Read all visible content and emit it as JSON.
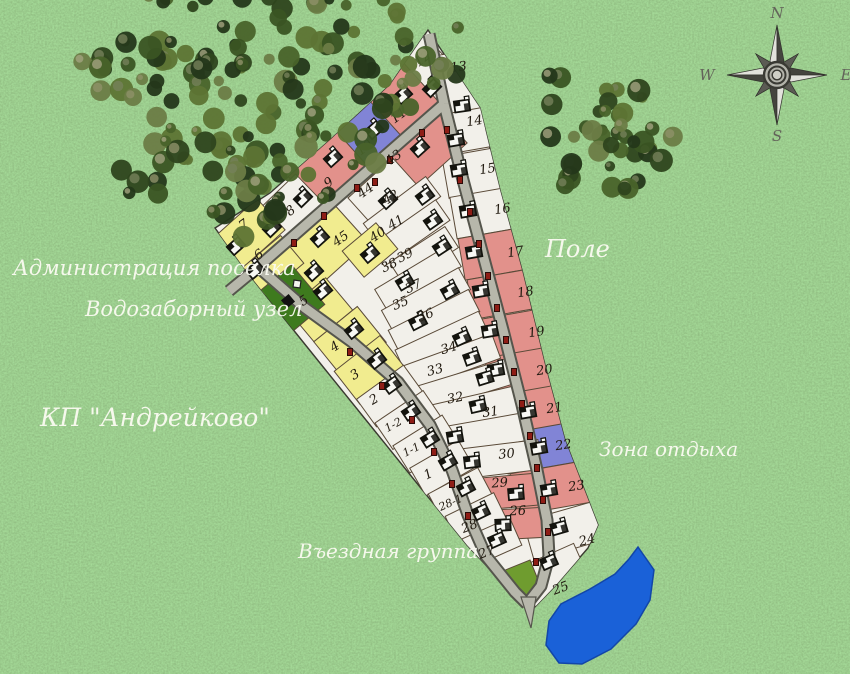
{
  "settlement_name": "КП \"Андрейково\"",
  "labels": {
    "administration": "Администрация поселка",
    "water_intake": "Водозаборный узел",
    "field": "Поле",
    "recreation_area": "Зона отдыха",
    "entrance_group": "Въездная группа"
  },
  "compass": {
    "north": "N",
    "west": "W",
    "east": "E",
    "south": "S"
  },
  "colors": {
    "plot_regular": "#f2f0ea",
    "plot_red": "#e2918b",
    "plot_blue": "#8184d6",
    "plot_yellow": "#f1ec8f",
    "plot_admin_green": "#3e7a1e",
    "plot_entrance_green": "#6f9c2f",
    "road_fill": "#b7b7ab",
    "road_edge": "#55554c",
    "water": "#1a61d8",
    "boundary": "#3a3a30"
  },
  "plots": [
    {
      "n": "12",
      "c": "p",
      "cx": 428,
      "cy": 68,
      "w": 40,
      "h": 58,
      "rot": -45,
      "lx": 425,
      "ly": 62,
      "hs": [
        [
          432,
          88
        ]
      ]
    },
    {
      "n": "13",
      "c": "p",
      "cx": 464,
      "cy": 92,
      "w": 50,
      "h": 80,
      "rot": -8,
      "lx": 459,
      "ly": 71,
      "hs": [
        [
          462,
          106
        ]
      ]
    },
    {
      "n": "14",
      "c": "p",
      "cx": 470,
      "cy": 130,
      "w": 58,
      "h": 40,
      "rot": -10,
      "lx": 475,
      "ly": 125,
      "hs": [
        [
          456,
          140
        ]
      ]
    },
    {
      "n": "15",
      "c": "p",
      "cx": 478,
      "cy": 172,
      "w": 66,
      "h": 42,
      "rot": -10,
      "lx": 488,
      "ly": 173,
      "hs": [
        [
          459,
          170
        ]
      ]
    },
    {
      "n": "16",
      "c": "p",
      "cx": 488,
      "cy": 212,
      "w": 70,
      "h": 42,
      "rot": -10,
      "lx": 503,
      "ly": 213,
      "hs": [
        [
          468,
          211
        ]
      ]
    },
    {
      "n": "17",
      "c": "r",
      "cx": 498,
      "cy": 253,
      "w": 74,
      "h": 42,
      "rot": -10,
      "lx": 516,
      "ly": 256,
      "hs": [
        [
          474,
          252
        ]
      ]
    },
    {
      "n": "18",
      "c": "r",
      "cx": 508,
      "cy": 293,
      "w": 76,
      "h": 40,
      "rot": -10,
      "lx": 526,
      "ly": 296,
      "hs": [
        [
          481,
          291
        ]
      ]
    },
    {
      "n": "19",
      "c": "r",
      "cx": 518,
      "cy": 333,
      "w": 78,
      "h": 40,
      "rot": -10,
      "lx": 537,
      "ly": 336,
      "hs": [
        [
          490,
          331
        ]
      ]
    },
    {
      "n": "20",
      "c": "r",
      "cx": 527,
      "cy": 371,
      "w": 80,
      "h": 40,
      "rot": -10,
      "lx": 545,
      "ly": 374,
      "hs": [
        [
          496,
          370
        ]
      ]
    },
    {
      "n": "21",
      "c": "r",
      "cx": 536,
      "cy": 409,
      "w": 82,
      "h": 40,
      "rot": -10,
      "lx": 555,
      "ly": 412,
      "hs": [
        [
          528,
          412
        ]
      ]
    },
    {
      "n": "22",
      "c": "b",
      "cx": 546,
      "cy": 447,
      "w": 84,
      "h": 40,
      "rot": -10,
      "lx": 564,
      "ly": 449,
      "hs": [
        [
          539,
          448
        ]
      ]
    },
    {
      "n": "23",
      "c": "r",
      "cx": 556,
      "cy": 487,
      "w": 86,
      "h": 42,
      "rot": -10,
      "lx": 577,
      "ly": 490,
      "hs": [
        [
          549,
          490
        ]
      ]
    },
    {
      "n": "24",
      "c": "p",
      "cx": 566,
      "cy": 530,
      "w": 78,
      "h": 40,
      "rot": -16,
      "lx": 588,
      "ly": 544,
      "hs": [
        [
          559,
          528
        ]
      ]
    },
    {
      "n": "25",
      "c": "p",
      "cx": 552,
      "cy": 576,
      "w": 66,
      "h": 42,
      "rot": -24,
      "lx": 562,
      "ly": 592,
      "hs": [
        [
          549,
          562
        ]
      ]
    },
    {
      "n": "11",
      "c": "r",
      "cx": 398,
      "cy": 100,
      "w": 58,
      "h": 60,
      "rot": -42,
      "lx": 401,
      "ly": 119,
      "hs": [
        [
          403,
          95
        ]
      ]
    },
    {
      "n": "10",
      "c": "b",
      "cx": 365,
      "cy": 133,
      "w": 50,
      "h": 55,
      "rot": -42,
      "lx": 367,
      "ly": 151,
      "hs": [
        [
          374,
          130
        ]
      ]
    },
    {
      "n": "9",
      "c": "r",
      "cx": 325,
      "cy": 168,
      "w": 66,
      "h": 52,
      "rot": -42,
      "lx": 331,
      "ly": 186,
      "hs": [
        [
          333,
          158
        ]
      ]
    },
    {
      "n": "43",
      "c": "r",
      "cx": 425,
      "cy": 150,
      "w": 72,
      "h": 46,
      "rot": -42,
      "lx": 396,
      "ly": 161,
      "hs": [
        [
          420,
          148
        ]
      ]
    },
    {
      "n": "44",
      "c": "p",
      "cx": 383,
      "cy": 192,
      "w": 60,
      "h": 38,
      "rot": -42,
      "lx": 368,
      "ly": 194,
      "hs": [
        [
          388,
          200
        ]
      ]
    },
    {
      "n": "45",
      "c": "y",
      "cx": 318,
      "cy": 250,
      "w": 85,
      "h": 55,
      "rot": -42,
      "lx": 343,
      "ly": 242,
      "hs": [
        [
          320,
          238
        ],
        [
          314,
          272
        ]
      ]
    },
    {
      "n": "42",
      "c": "p",
      "cx": 402,
      "cy": 210,
      "w": 78,
      "h": 25,
      "rot": -37,
      "lx": 393,
      "ly": 201,
      "hs": [
        [
          425,
          196
        ]
      ]
    },
    {
      "n": "41",
      "c": "p",
      "cx": 410,
      "cy": 233,
      "w": 80,
      "h": 25,
      "rot": -35,
      "lx": 398,
      "ly": 226,
      "hs": [
        [
          433,
          221
        ]
      ]
    },
    {
      "n": "40",
      "c": "y",
      "cx": 370,
      "cy": 250,
      "w": 44,
      "h": 34,
      "rot": -40,
      "lx": 380,
      "ly": 238,
      "hs": [
        [
          370,
          254
        ]
      ]
    },
    {
      "n": "39",
      "c": "p",
      "cx": 424,
      "cy": 255,
      "w": 66,
      "h": 25,
      "rot": -33,
      "lx": 407,
      "ly": 259,
      "hs": [
        [
          442,
          247
        ]
      ]
    },
    {
      "n": "38",
      "c": "p",
      "cx": 418,
      "cy": 278,
      "w": 86,
      "h": 25,
      "rot": -31,
      "lx": 391,
      "ly": 269,
      "hs": [
        [
          405,
          282
        ]
      ]
    },
    {
      "n": "37",
      "c": "p",
      "cx": 426,
      "cy": 300,
      "w": 88,
      "h": 25,
      "rot": -29,
      "lx": 415,
      "ly": 290,
      "hs": [
        [
          450,
          291
        ]
      ]
    },
    {
      "n": "35",
      "c": "p",
      "cx": 434,
      "cy": 321,
      "w": 90,
      "h": 25,
      "rot": -27,
      "lx": 402,
      "ly": 307,
      "hs": [
        [
          418,
          322
        ]
      ]
    },
    {
      "n": "36",
      "c": "p",
      "cx": 442,
      "cy": 342,
      "w": 92,
      "h": 25,
      "rot": -25,
      "lx": 427,
      "ly": 319,
      "hs": [
        [
          462,
          338
        ]
      ]
    },
    {
      "n": "34",
      "c": "p",
      "cx": 452,
      "cy": 362,
      "w": 94,
      "h": 26,
      "rot": -20,
      "lx": 450,
      "ly": 352,
      "hs": [
        [
          472,
          358
        ]
      ]
    },
    {
      "n": "33",
      "c": "p",
      "cx": 462,
      "cy": 386,
      "w": 96,
      "h": 26,
      "rot": -17,
      "lx": 436,
      "ly": 374,
      "hs": [
        [
          485,
          378
        ]
      ]
    },
    {
      "n": "32",
      "c": "p",
      "cx": 472,
      "cy": 410,
      "w": 96,
      "h": 28,
      "rot": -13,
      "lx": 456,
      "ly": 402,
      "hs": [
        [
          478,
          406
        ]
      ]
    },
    {
      "n": "31",
      "c": "p",
      "cx": 483,
      "cy": 434,
      "w": 94,
      "h": 28,
      "rot": -10,
      "lx": 491,
      "ly": 416,
      "hs": [
        [
          455,
          437
        ]
      ]
    },
    {
      "n": "30",
      "c": "p",
      "cx": 494,
      "cy": 460,
      "w": 92,
      "h": 30,
      "rot": -7,
      "lx": 507,
      "ly": 458,
      "hs": [
        [
          472,
          462
        ]
      ]
    },
    {
      "n": "29",
      "c": "r",
      "cx": 504,
      "cy": 492,
      "w": 74,
      "h": 32,
      "rot": -5,
      "lx": 500,
      "ly": 487,
      "hs": [
        [
          516,
          494
        ]
      ]
    },
    {
      "n": "26",
      "c": "r",
      "cx": 512,
      "cy": 524,
      "w": 62,
      "h": 30,
      "rot": -3,
      "lx": 518,
      "ly": 515,
      "hs": [
        [
          503,
          525
        ]
      ]
    },
    {
      "n": "8",
      "c": "p",
      "cx": 290,
      "cy": 210,
      "w": 58,
      "h": 44,
      "rot": -44,
      "lx": 293,
      "ly": 214,
      "hs": [
        [
          303,
          198
        ],
        [
          272,
          228
        ]
      ]
    },
    {
      "n": "7",
      "c": "y",
      "cx": 248,
      "cy": 235,
      "w": 62,
      "h": 42,
      "rot": -42,
      "lx": 246,
      "ly": 228,
      "hs": [
        [
          236,
          246
        ]
      ]
    },
    {
      "n": "6",
      "c": "y",
      "cx": 270,
      "cy": 268,
      "w": 58,
      "h": 36,
      "rot": -40,
      "lx": 261,
      "ly": 258,
      "hs": [
        [
          255,
          270
        ]
      ]
    },
    {
      "n": "5",
      "c": "y",
      "cx": 320,
      "cy": 310,
      "w": 50,
      "h": 42,
      "rot": -40,
      "lx": 306,
      "ly": 304,
      "hs": [
        [
          323,
          291
        ]
      ]
    },
    {
      "n": "4",
      "c": "y",
      "cx": 350,
      "cy": 342,
      "w": 56,
      "h": 46,
      "rot": -39,
      "lx": 337,
      "ly": 350,
      "hs": [
        [
          354,
          330
        ]
      ]
    },
    {
      "n": "3",
      "c": "y",
      "cx": 370,
      "cy": 370,
      "w": 58,
      "h": 42,
      "rot": -38,
      "lx": 357,
      "ly": 378,
      "hs": [
        [
          377,
          360
        ]
      ]
    },
    {
      "n": "2",
      "c": "p",
      "cx": 390,
      "cy": 396,
      "w": 58,
      "h": 34,
      "rot": -36,
      "lx": 376,
      "ly": 403,
      "hs": [
        [
          392,
          385
        ]
      ]
    },
    {
      "n": "1-2",
      "c": "p",
      "cx": 408,
      "cy": 420,
      "w": 58,
      "h": 32,
      "rot": -34,
      "lx": 395,
      "ly": 428,
      "hs": [
        [
          411,
          412
        ]
      ]
    },
    {
      "n": "1-1",
      "c": "p",
      "cx": 426,
      "cy": 444,
      "w": 58,
      "h": 32,
      "rot": -32,
      "lx": 413,
      "ly": 453,
      "hs": [
        [
          430,
          439
        ]
      ]
    },
    {
      "n": "1",
      "c": "p",
      "cx": 442,
      "cy": 468,
      "w": 56,
      "h": 32,
      "rot": -30,
      "lx": 430,
      "ly": 478,
      "hs": [
        [
          448,
          462
        ]
      ]
    },
    {
      "n": "28-1",
      "c": "p",
      "cx": 460,
      "cy": 494,
      "w": 56,
      "h": 30,
      "rot": -28,
      "lx": 452,
      "ly": 506,
      "hs": [
        [
          466,
          488
        ]
      ]
    },
    {
      "n": "28",
      "c": "p",
      "cx": 476,
      "cy": 518,
      "w": 54,
      "h": 30,
      "rot": -26,
      "lx": 471,
      "ly": 530,
      "hs": [
        [
          481,
          512
        ]
      ]
    },
    {
      "n": "27",
      "c": "p",
      "cx": 492,
      "cy": 542,
      "w": 52,
      "h": 30,
      "rot": -24,
      "lx": 488,
      "ly": 556,
      "hs": [
        [
          497,
          540
        ]
      ]
    },
    {
      "n": "",
      "c": "g1",
      "cx": 292,
      "cy": 298,
      "w": 42,
      "h": 52,
      "rot": -40,
      "lx": 0,
      "ly": 0,
      "hs": []
    },
    {
      "n": "",
      "c": "g2",
      "cx": 516,
      "cy": 584,
      "w": 44,
      "h": 34,
      "rot": -22,
      "lx": 0,
      "ly": 0,
      "hs": []
    }
  ],
  "gates": [
    [
      422,
      133
    ],
    [
      390,
      160
    ],
    [
      357,
      188
    ],
    [
      324,
      216
    ],
    [
      294,
      243
    ],
    [
      460,
      180
    ],
    [
      470,
      212
    ],
    [
      479,
      244
    ],
    [
      488,
      276
    ],
    [
      497,
      308
    ],
    [
      506,
      340
    ],
    [
      514,
      372
    ],
    [
      522,
      404
    ],
    [
      530,
      436
    ],
    [
      537,
      468
    ],
    [
      543,
      500
    ],
    [
      350,
      352
    ],
    [
      382,
      386
    ],
    [
      412,
      420
    ],
    [
      434,
      452
    ],
    [
      452,
      484
    ],
    [
      468,
      516
    ],
    [
      548,
      532
    ],
    [
      536,
      562
    ],
    [
      375,
      182
    ],
    [
      447,
      130
    ]
  ]
}
